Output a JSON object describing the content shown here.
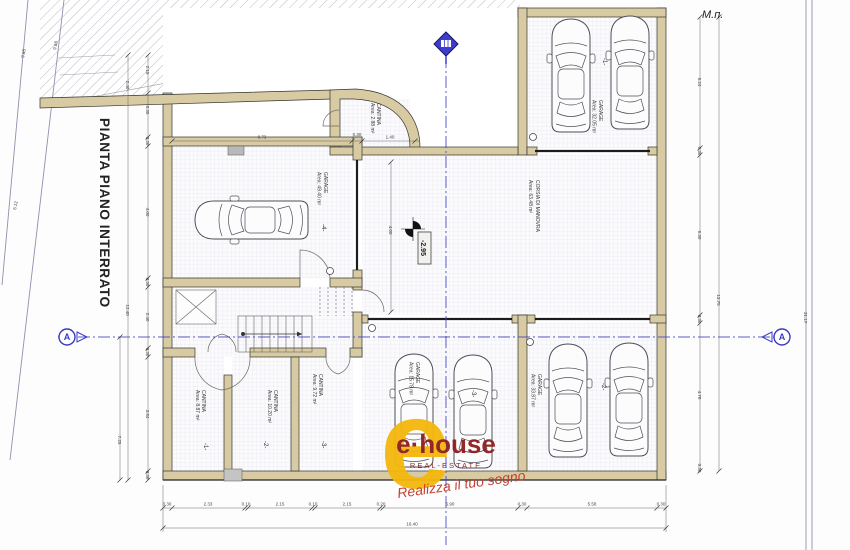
{
  "title": "PIANTA PIANO INTERRATO",
  "corner_note": "М.п.",
  "section_marker": "A",
  "level": "-2.95",
  "rooms": {
    "garage1": {
      "name": "GARAGE",
      "area": "Area: 32.05 m²",
      "marker": "-1-"
    },
    "garage2": {
      "name": "GARAGE",
      "area": "Area: 33.87 m²",
      "marker": "-2-"
    },
    "garage3": {
      "name": "GARAGE",
      "area": "Area: 15.78 m²",
      "marker": "-3-"
    },
    "garage4": {
      "name": "GARAGE",
      "area": "Area: 49.40 m²",
      "marker": "-4-"
    },
    "corsia": {
      "name": "CORSIA DI MANOVRA",
      "area": "Area: 63.48 m²"
    },
    "cantina_top": {
      "name": "CANTINA",
      "area": "Area: 2.88 m²"
    },
    "cantina1": {
      "name": "CANTINA",
      "area": "Area: 8.87 m²",
      "marker": "-1-"
    },
    "cantina2": {
      "name": "CANTINA",
      "area": "Area: 10.20 m²",
      "marker": "-2-"
    },
    "cantina3": {
      "name": "CANTINA",
      "area": "Area: 9.72 m²",
      "marker": "-3-"
    }
  },
  "logo": {
    "wordmark": "e·house",
    "tagline": "REAL-ESTATE",
    "script": "Realizza il tuo sogno"
  },
  "dims": {
    "bottom": [
      "0.30",
      "2.33",
      "0.10",
      "2.15",
      "0.10",
      "2.15",
      "0.20",
      "5.90",
      "0.30",
      "5.58",
      "0.30"
    ],
    "bottom_total": "16.40",
    "top": [
      "8.73",
      "0.30",
      "1.40"
    ],
    "left": [
      "0.30",
      "4.00",
      "0.30",
      "2.40",
      "0.30",
      "3.84",
      "0.30"
    ],
    "left_upper": [
      "2.15",
      "0.35",
      "2.40"
    ],
    "left_total": "12.40",
    "left_outer": "7.25",
    "right": [
      "6.24",
      "0.30",
      "6.30",
      "0.30",
      "4.78",
      "0.30"
    ],
    "right_total": "13.75",
    "interior_corsia": "4.00",
    "boundary_right": "31.17",
    "boundary_left": [
      "9.65",
      "9.68",
      "5.12"
    ]
  },
  "colors": {
    "wall_tan": "#d8cba4",
    "section_blue": "#4040c6",
    "logo_yellow": "#f4b70c",
    "logo_red": "#8e1d1d"
  }
}
